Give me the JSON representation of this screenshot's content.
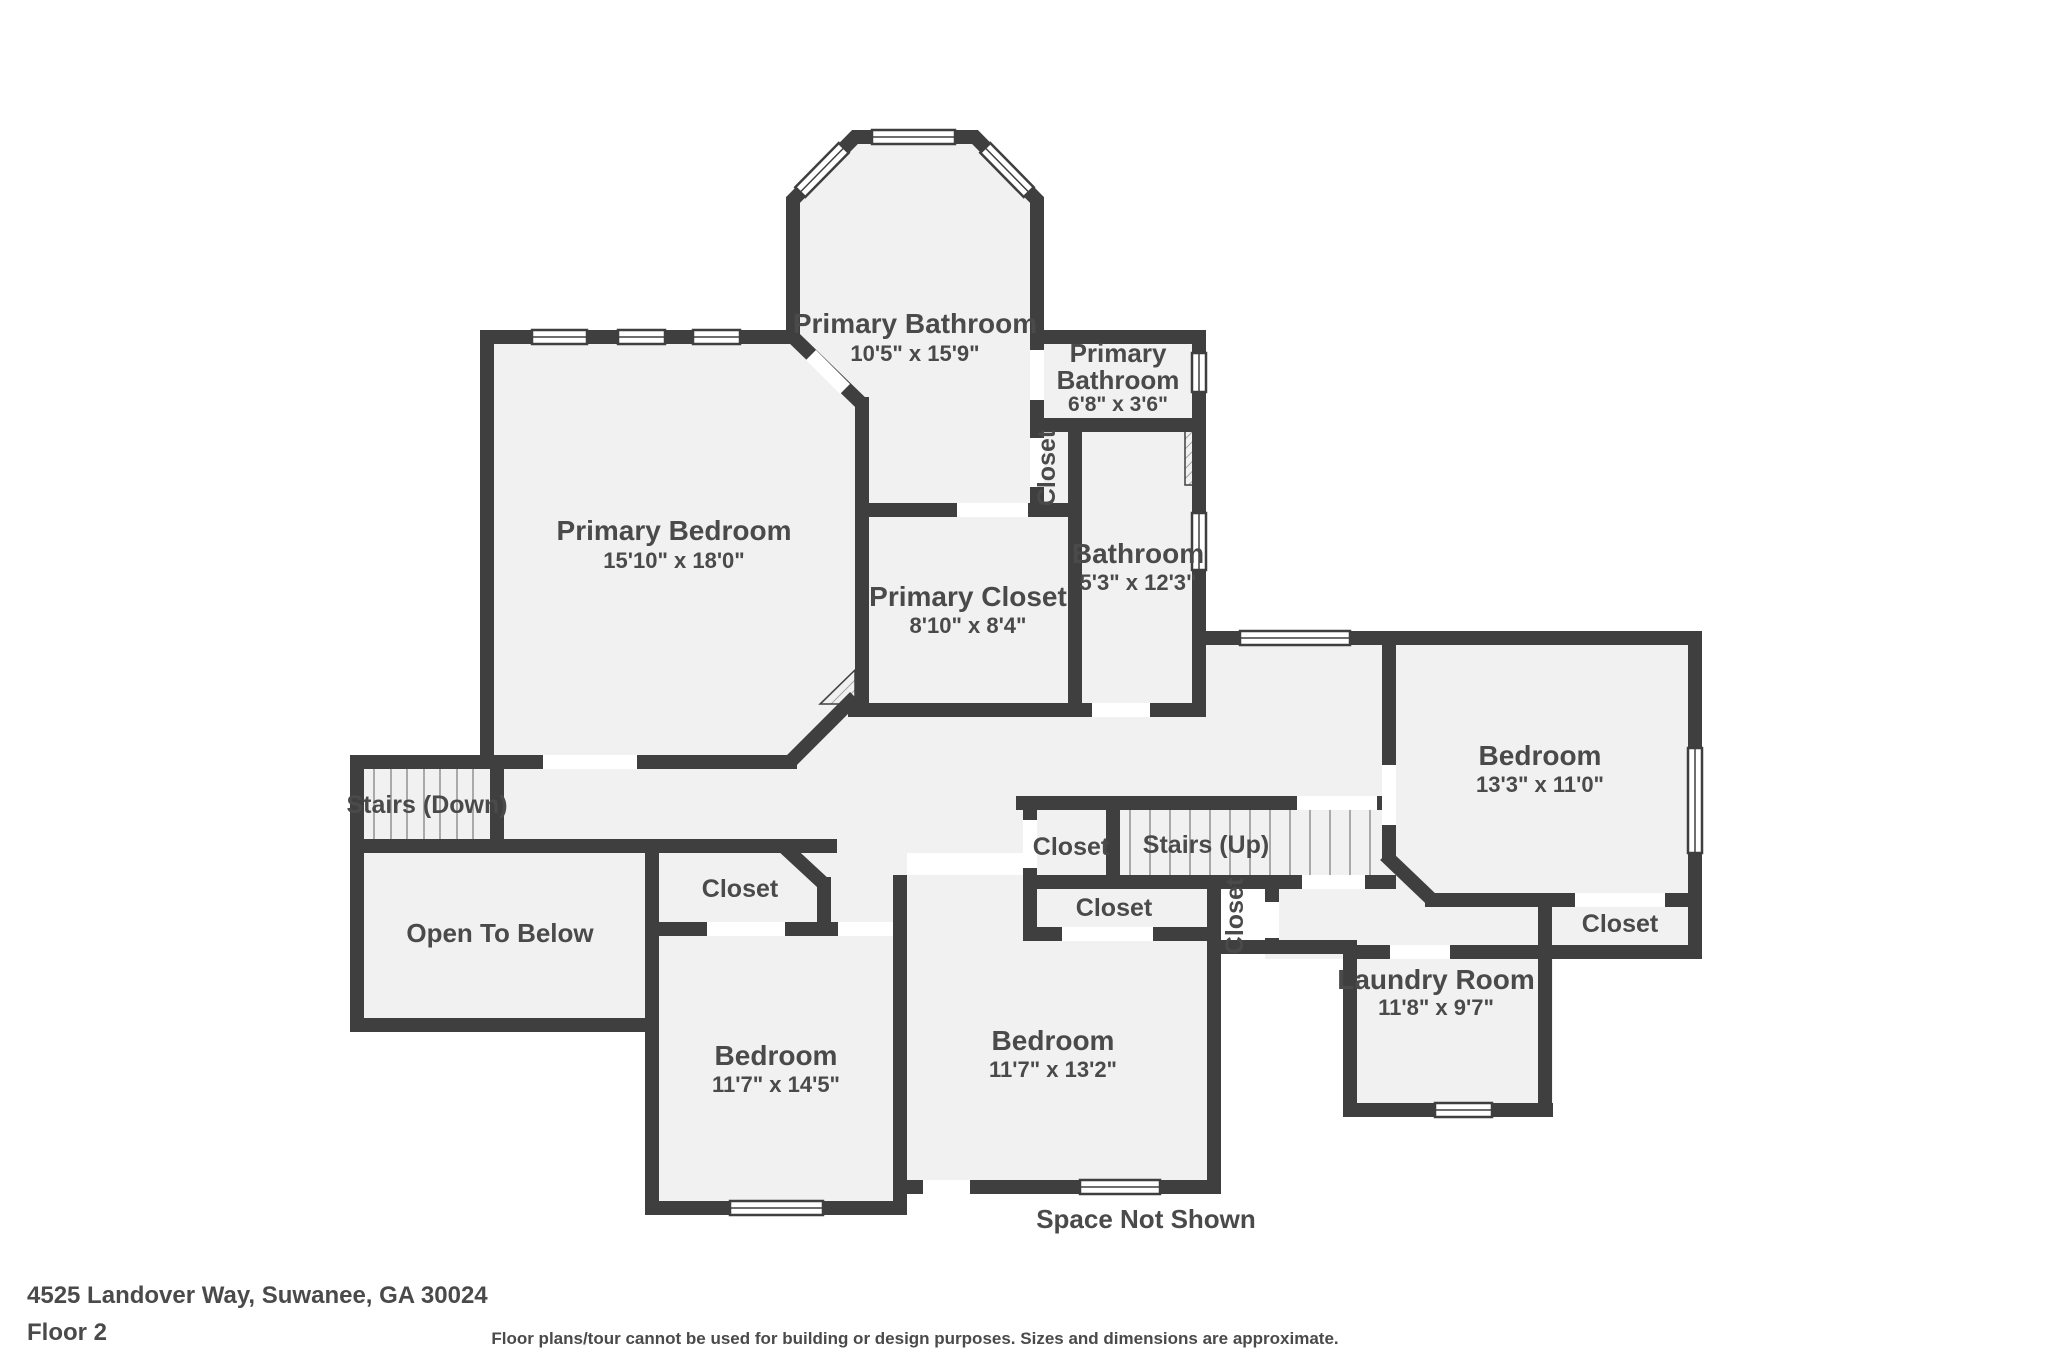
{
  "footer": {
    "address": "4525 Landover Way, Suwanee, GA 30024",
    "floor": "Floor 2",
    "disclaimer": "Floor plans/tour cannot be used for building or design purposes. Sizes and dimensions are approximate."
  },
  "colors": {
    "wall": "#3f3f3f",
    "room_fill": "#f1f1f2",
    "stair_tread": "#a9a9a9",
    "text": "#4a4a4a",
    "background": "#ffffff"
  },
  "rooms": {
    "primary_bathroom": {
      "name": "Primary Bathroom",
      "dims": "10'5\" x 15'9\""
    },
    "primary_bathroom_small": {
      "name_line1": "Primary",
      "name_line2": "Bathroom",
      "dims": "6'8\" x 3'6\""
    },
    "closet_hall": {
      "name": "Closet"
    },
    "bathroom": {
      "name": "Bathroom",
      "dims": "5'3\" x 12'3\""
    },
    "primary_bedroom": {
      "name": "Primary Bedroom",
      "dims": "15'10\" x 18'0\""
    },
    "primary_closet": {
      "name": "Primary Closet",
      "dims": "8'10\" x 8'4\""
    },
    "stairs_down": {
      "name": "Stairs (Down)"
    },
    "open_to_below": {
      "name": "Open To Below"
    },
    "closet_bedroom_left": {
      "name": "Closet"
    },
    "bedroom_left": {
      "name": "Bedroom",
      "dims": "11'7\" x 14'5\""
    },
    "bedroom_middle": {
      "name": "Bedroom",
      "dims": "11'7\" x 13'2\""
    },
    "closet_stairs": {
      "name": "Closet"
    },
    "stairs_up": {
      "name": "Stairs (Up)"
    },
    "closet_middle": {
      "name": "Closet"
    },
    "closet_middle_vertical": {
      "name": "Closet"
    },
    "bedroom_right": {
      "name": "Bedroom",
      "dims": "13'3\" x 11'0\""
    },
    "closet_bedroom_right": {
      "name": "Closet"
    },
    "laundry_room": {
      "name": "Laundry Room",
      "dims": "11'8\" x 9'7\""
    },
    "space_not_shown": {
      "label": "Space Not Shown"
    }
  }
}
